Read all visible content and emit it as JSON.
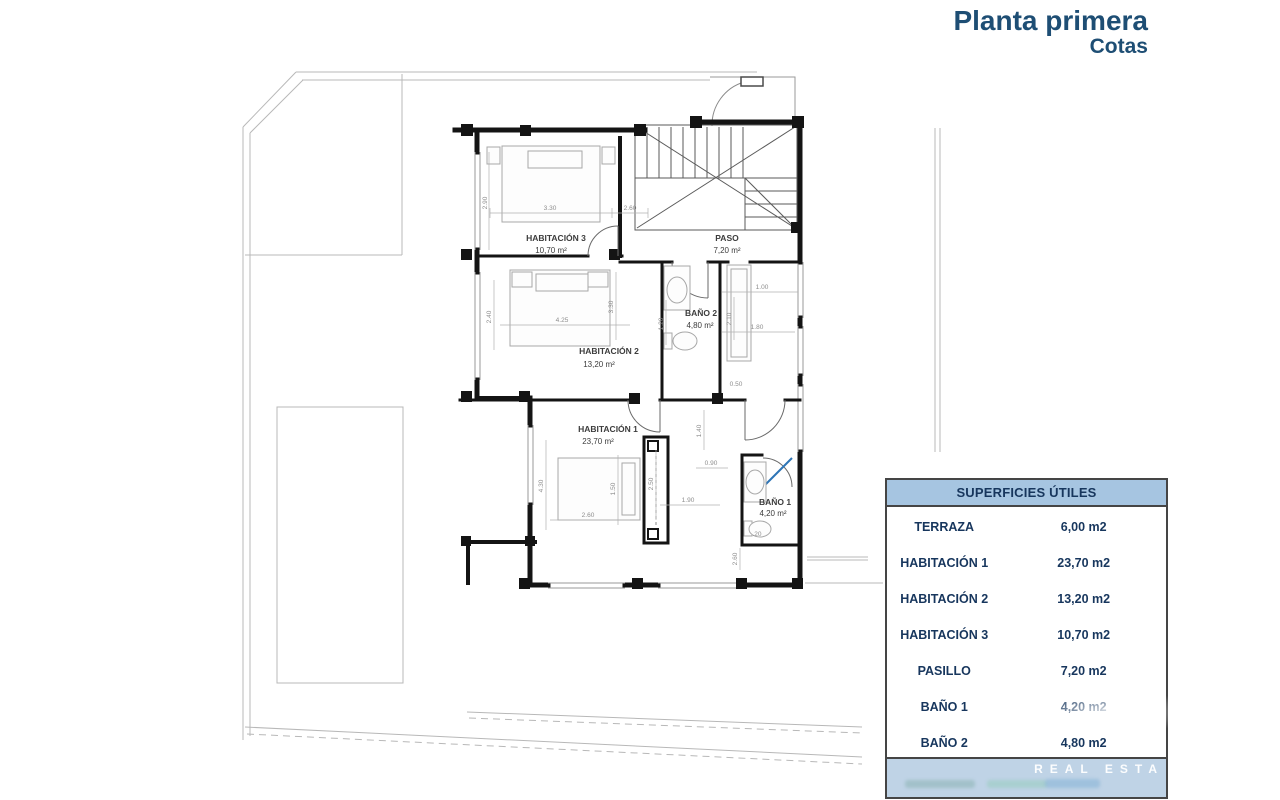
{
  "title": {
    "line1": "Planta primera",
    "line2": "Cotas",
    "color": "#1e4e74"
  },
  "plan": {
    "rooms": [
      {
        "id": "habitacion3",
        "label": "HABITACIÓN 3",
        "area": "10,70 m²"
      },
      {
        "id": "paso",
        "label": "PASO",
        "area": "7,20 m²"
      },
      {
        "id": "habitacion2",
        "label": "HABITACIÓN 2",
        "area": "13,20 m²"
      },
      {
        "id": "bano2",
        "label": "BAÑO 2",
        "area": "4,80 m²"
      },
      {
        "id": "habitacion1",
        "label": "HABITACIÓN 1",
        "area": "23,70 m²"
      },
      {
        "id": "bano1",
        "label": "BAÑO 1",
        "area": "4,20 m²"
      }
    ],
    "dimensions": [
      "2.90",
      "3.30",
      "2.60",
      "2.40",
      "4.25",
      "3.30",
      "1.20",
      "1.00",
      "2.10",
      "1.80",
      "0.50",
      "4.30",
      "1.50",
      "2.50",
      "2.60",
      "1.90",
      "1.40",
      "0.90",
      ".20",
      "2.60"
    ],
    "accent_color": "#2e75b6",
    "wall_color": "#141414"
  },
  "table": {
    "header": "SUPERFICIES ÚTILES",
    "rows": [
      {
        "label": "TERRAZA",
        "value": "6,00 m2"
      },
      {
        "label": "HABITACIÓN 1",
        "value": "23,70 m2"
      },
      {
        "label": "HABITACIÓN 2",
        "value": "13,20 m2"
      },
      {
        "label": "HABITACIÓN 3",
        "value": "10,70 m2"
      },
      {
        "label": "PASILLO",
        "value": "7,20 m2"
      },
      {
        "label": "BAÑO 1",
        "value": "4,20 m2"
      },
      {
        "label": "BAÑO 2",
        "value": "4,80 m2"
      }
    ],
    "header_bg": "#a6c5e1",
    "footer_bg": "#bfd3e6",
    "text_color": "#17365d"
  },
  "watermark": {
    "text": "REAL ESTA"
  }
}
